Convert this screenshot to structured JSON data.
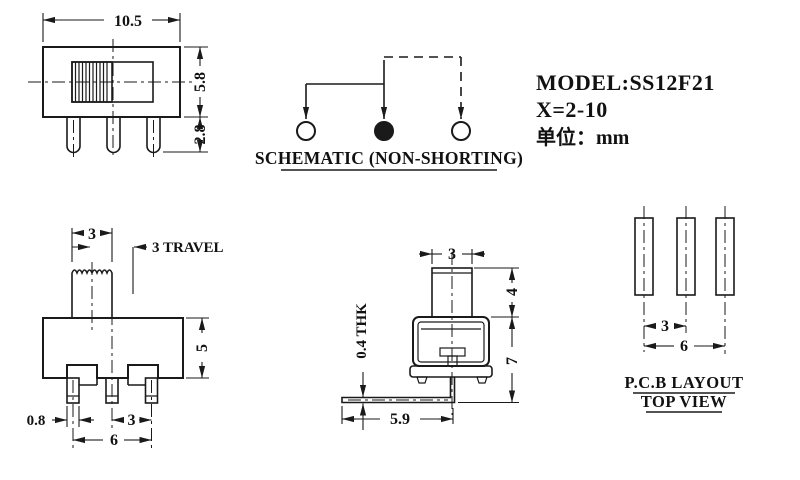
{
  "title_block": {
    "model": "MODEL:SS12F21",
    "x_range": "X=2-10",
    "unit": "单位：mm"
  },
  "front_view": {
    "dim_width": "10.5",
    "dim_height": "5.8",
    "dim_pin_length": "2.8"
  },
  "schematic": {
    "caption": "SCHEMATIC (NON-SHORTING)",
    "terminals": [
      "open",
      "filled",
      "open"
    ]
  },
  "side_view": {
    "dim_knob_width": "3",
    "dim_travel": "3 TRAVEL",
    "dim_body_height": "5",
    "dim_pin_width": "0.8",
    "dim_pin_pitch": "3",
    "dim_pin_span": "6"
  },
  "end_view": {
    "dim_knob_width": "3",
    "dim_knob_height": "4",
    "dim_body_height": "7",
    "dim_lead_thickness": "0.4 THK",
    "dim_lead_length": "5.9"
  },
  "pcb_layout": {
    "title": "P.C.B LAYOUT",
    "subtitle": "TOP VIEW",
    "dim_pitch": "3",
    "dim_span": "6"
  },
  "colors": {
    "line": "#1a1a1a",
    "background": "#ffffff"
  }
}
